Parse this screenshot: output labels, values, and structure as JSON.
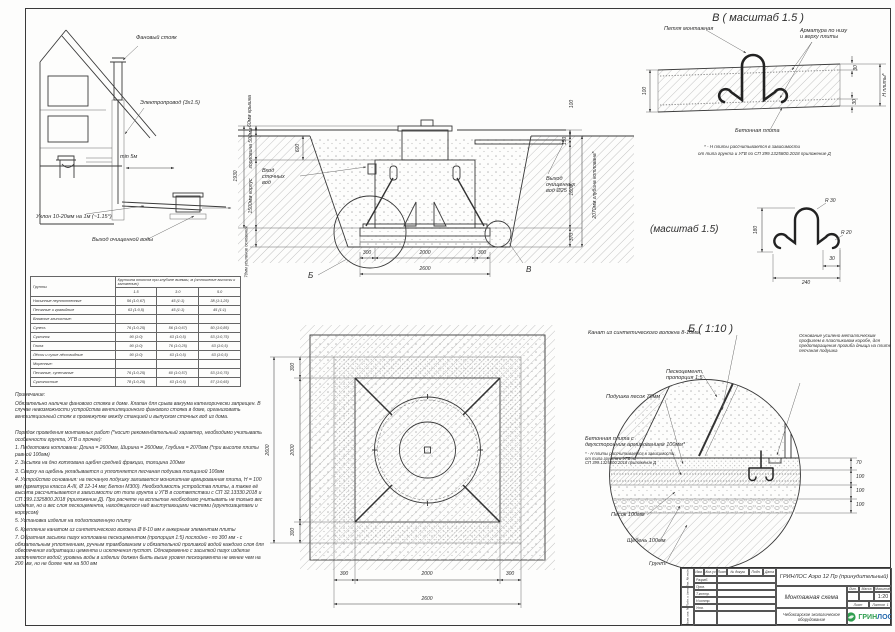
{
  "house": {
    "stack": "Фановый стояк",
    "wire": "Электропровод (3х1.5)",
    "min5": "min 5м",
    "slope": "Уклон 10-20мм на 1м (~1.15°)",
    "outflow": "Выход очищенной воды"
  },
  "section": {
    "dim_cover": "60мм крышка",
    "dim_neck": "горловина 500мм",
    "dim_total": "1930",
    "dim_body": "1500мм корпус",
    "dim_base": "70мм усиление основания",
    "dim_600": "600",
    "inlet_1": "Вход",
    "inlet_2": "сточных",
    "inlet_3": "вод",
    "outlet_1": "Выход",
    "outlet_2": "очищенных",
    "outlet_3": "вод Ø25",
    "dim_100": "100",
    "dim_150": "150",
    "dim_1600": "1600",
    "dim_370": "370",
    "dim_depth": "2070мм глубина котлована*",
    "d300": "300",
    "d2000": "2000",
    "d2600": "2600",
    "det_b": "Б",
    "det_v": "В"
  },
  "detail_v": {
    "title": "В ( масштаб 1.5 )",
    "loop_label": "Петля монтажная",
    "rebar_1": "Арматура по низу",
    "rebar_2": "и верху плиты",
    "slab_label": "Бетонная плита",
    "dim_100": "100",
    "dim_30": "30",
    "dim_h": "Н плиты*",
    "foot_1": "* - Н плиты рассчитывается в зависимости",
    "foot_2": "от типа грунта и УГВ по СП 399.1325800.2018 приложение Д"
  },
  "loop_detail": {
    "title": "(масштаб 1.5)",
    "r30": "R 30",
    "r20": "R 20",
    "d180": "180",
    "d240": "240",
    "d30": "30"
  },
  "detail_b": {
    "title": "Б ( 1:10 )",
    "rope": "Канат из синтетического волокна 8-10мм",
    "pesko_1": "Пескоцемент,",
    "pesko_2": "пропорция 1:5",
    "cushion": "Подушка песок 70мм",
    "slab_1": "Бетонная плита с",
    "slab_2": "двухсторонним армированием 100мм*",
    "foot_1": "* - Н плиты рассчитывается в зависимости",
    "foot_2": "от типа грунта и УГВ по",
    "foot_3": "СП 399.1325800.2018 приложение Д",
    "sand": "Песок 100мм",
    "rubble": "Щебень 100мм",
    "soil": "Грунт",
    "note": "Основание усилено металлическим профилем в пластиковом коробе, для предотвращения прогиба днища на плите песчаная подушка",
    "d70": "70",
    "d100": "100"
  },
  "plan": {
    "d2600": "2600",
    "d2000": "2000",
    "d300": "300"
  },
  "soil_table": {
    "col_soil": "Грунты",
    "col_slope": "Крутизна откосов при глубине выемки, м (отношение высоты к заложению)",
    "depths": [
      "1.5",
      "3.0",
      "5.0"
    ],
    "rows": [
      {
        "name": "Насыпные неуплотненные",
        "v": [
          "56 (1:0,67)",
          "45 (1:1)",
          "38 (1:1,25)"
        ]
      },
      {
        "name": "Песчаные и гравийные",
        "v": [
          "63 (1:0,5)",
          "45 (1:1)",
          "45 (1:1)"
        ]
      },
      {
        "name": "Влажные глинистые:",
        "v": [
          "",
          "",
          ""
        ]
      },
      {
        "name": "Супесь",
        "v": [
          "76 (1:0,25)",
          "56 (1:0,67)",
          "50 (1:0,85)"
        ]
      },
      {
        "name": "Суглинок",
        "v": [
          "90 (1:0)",
          "63 (1:0,5)",
          "53 (1:0,75)"
        ]
      },
      {
        "name": "Глина",
        "v": [
          "90 (1:0)",
          "76 (1:0,25)",
          "63 (1:0,5)"
        ]
      },
      {
        "name": "Лёссы и сухие лёссовидные",
        "v": [
          "90 (1:0)",
          "63 (1:0,5)",
          "63 (1:0,5)"
        ]
      },
      {
        "name": "Моренные:",
        "v": [
          "",
          "",
          ""
        ]
      },
      {
        "name": "Песчаные, супесчаные",
        "v": [
          "76 (1:0,25)",
          "60 (1:0,57)",
          "53 (1:0,75)"
        ]
      },
      {
        "name": "Суглинистые",
        "v": [
          "78 (1:0,25)",
          "63 (1:0,5)",
          "57 (1:0,65)"
        ]
      }
    ]
  },
  "notes": {
    "title": "Примечание:",
    "para": "Обязательно наличие фанового стояка в доме. Клапан для срыва вакуума категорически запрещен. В случае невозможности устройства вентиляционного фанового стояка в доме, организовать вентиляционный стояк в промежутке между станцией и выпуском сточных вод из дома.",
    "order_title": "Порядок проведения монтажных работ (*носит рекомендательный характер, необходимо учитывать особенности грунта, УГВ и прочее):",
    "items": [
      "1. Подготовка котлована: Длина = 2600мм,  Ширина = 2600мм, Глубина = 2070мм (*при высоте плиты равной 100мм)",
      "2. Засыпка на дно котлована щебня средней фракции, толщина 100мм",
      "3. Сверху на щебень укладывается и уплотняется песчаная подушка толщиной 100мм",
      "4. Устройство основания: на песчаную подушку заливается монолитная армированная плита, Н = 100 мм (арматура класса А-III, Ø 12-14 мм; Бетон М300). Необходимость устройства плиты, а также её высота рассчитывается в зависимости от типа грунта и УГВ в соответствии с СП 32.13330.2018 и СП 399.1325800.2018 (приложение Д). При расчете на всплытие необходимо учитывать не только вес изделия, но и вес слоя пескоцемента, находящегося над выступающими частями (грунтозацепами и корпусом)",
      "5. Установка изделия на подготовленную плиту",
      "6. Крепление канатом из синтетического волокна Ø 8-10 мм к анкерным элементам плиты",
      "7. Обратная засыпка пазух котлована пескоцементом (пропорция 1:5) послойно - по 300 мм - с обязательным уплотнением, ручным трамбованием и обязательной проливкой водой каждого слоя для обеспечения гидратации цемента и исключения пустот. Одновременно с засыпкой пазух изделие заполняется водой; уровень воды в изделии должен быть выше уровня пескоцемента не менее чем на 200 мм, но не более чем на 500 мм"
    ]
  },
  "title_block": {
    "doc": "ГРИНЛОС Аэро 12 Пр (принудительный)",
    "name": "Монтажная схема",
    "company": "Чебоксарское экологическое оборудование",
    "lit": "Лит.",
    "mass": "Масса",
    "scale_label": "Масштаб",
    "scale": "1:20",
    "sheet_label": "Лист",
    "sheets_label": "Листов",
    "sheets": "1",
    "hdr": [
      "Изм.",
      "Кол.уч",
      "Лист",
      "№ докум.",
      "Подп.",
      "Дата"
    ],
    "staff": [
      "Разраб.",
      "Пров.",
      "Т.контр.",
      "Н.контр.",
      "Утв."
    ],
    "side": [
      "Инв. № подл.",
      "Подп. и дата",
      "Взам. инв. №"
    ],
    "logo_1": "ГРИН",
    "logo_2": "ЛОС",
    "accent_green": "#2f9e4f",
    "accent_blue": "#2569ad"
  }
}
